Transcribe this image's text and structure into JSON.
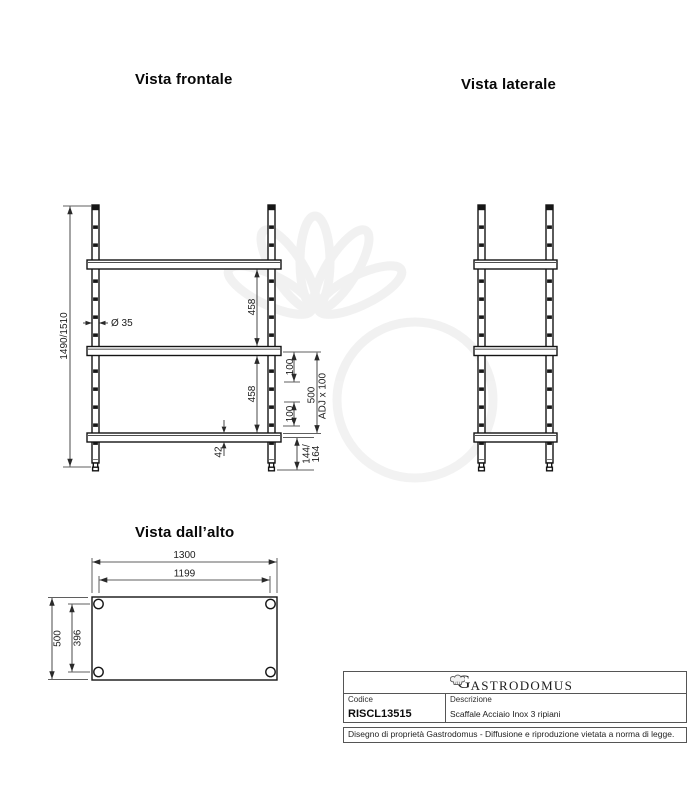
{
  "page": {
    "background": "#ffffff",
    "line_color": "#141414",
    "dim_color": "#2a2a2a"
  },
  "views": {
    "front": {
      "title": "Vista frontale",
      "dims": {
        "overall_height": "1490/1510",
        "tube_diameter": "Ø 35",
        "shelf_gap_top": "458",
        "shelf_gap_bottom": "458",
        "slot_step_a": "100",
        "slot_step_b": "100",
        "adj_range": "500",
        "adj_step": "ADJ x 100",
        "shelf_thickness": "42",
        "foot_min": "144/",
        "foot_max": "164"
      }
    },
    "side": {
      "title": "Vista laterale"
    },
    "top": {
      "title": "Vista dall’alto",
      "dims": {
        "width_overall": "1300",
        "width_between_legs": "1199",
        "depth_overall": "500",
        "depth_between_legs": "396"
      }
    }
  },
  "title_block": {
    "brand_initial": "G",
    "brand_rest": "ASTRODOMUS",
    "code_label": "Codice",
    "code_value": "RISCL13515",
    "description_label": "Descrizione",
    "description_value": "Scaffale Acciaio Inox 3 ripiani",
    "legal_notice": "Disegno di proprietà Gastrodomus - Diffusione e riproduzione vietata a norma di legge."
  }
}
